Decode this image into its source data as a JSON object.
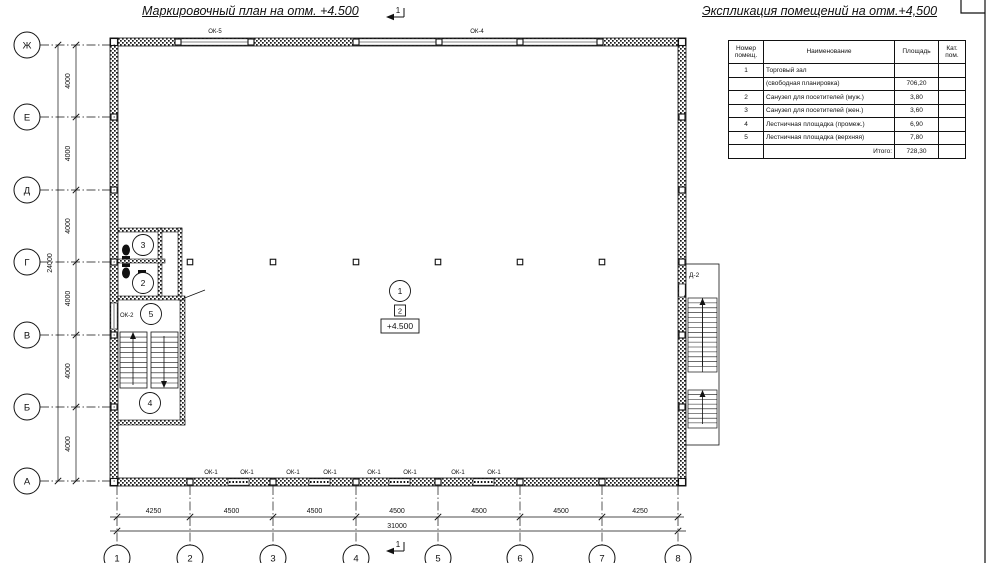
{
  "plan": {
    "title": "Маркировочный план на отм. +4.500",
    "section_label": "1",
    "level_mark": "+4.500",
    "floor_type": "2",
    "room_markers": {
      "hall": "1",
      "wc_men": "2",
      "wc_women": "3",
      "stair_mid": "4",
      "stair_top": "5"
    },
    "window_marks": {
      "top": [
        "ОК-5",
        "ОК-4"
      ],
      "bottom": [
        "ОК-1",
        "ОК-1",
        "ОК-1",
        "ОК-1",
        "ОК-1",
        "ОК-1",
        "ОК-1",
        "ОК-1"
      ],
      "left": "ОК-2"
    },
    "door_mark": "Д-2",
    "axes_vertical": [
      "Ж",
      "Е",
      "Д",
      "Г",
      "В",
      "Б",
      "А"
    ],
    "axes_horizontal": [
      "1",
      "2",
      "3",
      "4",
      "5",
      "6",
      "7",
      "8"
    ],
    "dims_left": {
      "segments": [
        "4000",
        "4000",
        "4000",
        "4000",
        "4000",
        "4000"
      ],
      "total": "24000"
    },
    "dims_bottom": {
      "segments": [
        "4250",
        "4500",
        "4500",
        "4500",
        "4500",
        "4500",
        "4250"
      ],
      "total": "31000"
    }
  },
  "schedule": {
    "title": "Экспликация помещений на отм.+4,500",
    "headers": {
      "num": "Номер помещ.",
      "name": "Наименование",
      "area": "Площадь",
      "cat": "Кат. пом."
    },
    "rows": [
      {
        "num": "1",
        "name": "Торговый зал",
        "area": "",
        "cat": ""
      },
      {
        "num": "",
        "name": "(свободная планировка)",
        "area": "706,20",
        "cat": ""
      },
      {
        "num": "2",
        "name": "Санузел для посетителей (муж.)",
        "area": "3,80",
        "cat": ""
      },
      {
        "num": "3",
        "name": "Санузел для посетителей (жен.)",
        "area": "3,60",
        "cat": ""
      },
      {
        "num": "4",
        "name": "Лестничная площадка (промеж.)",
        "area": "6,90",
        "cat": ""
      },
      {
        "num": "5",
        "name": "Лестничная площадка (верхняя)",
        "area": "7,80",
        "cat": ""
      }
    ],
    "total_label": "Итого:",
    "total_value": "728,30"
  },
  "colors": {
    "ink": "#111111",
    "paper": "#ffffff"
  }
}
